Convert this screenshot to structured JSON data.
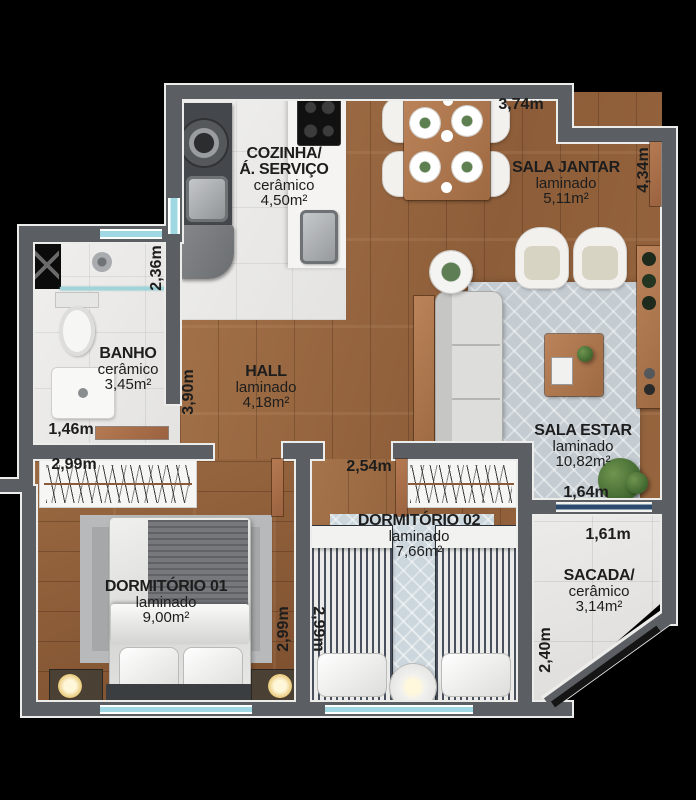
{
  "rooms": {
    "cozinha": {
      "name": "COZINHA/",
      "name2": "Á. SERVIÇO",
      "material": "cerâmico",
      "area": "4,50m²"
    },
    "sala_jantar": {
      "name": "SALA JANTAR",
      "material": "laminado",
      "area": "5,11m²"
    },
    "banho": {
      "name": "BANHO",
      "material": "cerâmico",
      "area": "3,45m²"
    },
    "hall": {
      "name": "HALL",
      "material": "laminado",
      "area": "4,18m²"
    },
    "sala_estar": {
      "name": "SALA ESTAR",
      "material": "laminado",
      "area": "10,82m²"
    },
    "dormitorio1": {
      "name": "DORMITÓRIO 01",
      "material": "laminado",
      "area": "9,00m²"
    },
    "dormitorio2": {
      "name": "DORMITÓRIO 02",
      "material": "laminado",
      "area": "7,66m²"
    },
    "sacada": {
      "name": "SACADA/",
      "material": "cerâmico",
      "area": "3,14m²"
    }
  },
  "dimensions": {
    "jantar_top": "3,74m",
    "entry_right": "4,34m",
    "banho_height": "2,36m",
    "banho_width": "1,46m",
    "hall_height": "3,90m",
    "dorm1_closet_width": "2,99m",
    "dorm1_height": "2,99m",
    "dorm2_height": "2,99m",
    "dorm2_width": "2,54m",
    "estar_bottom_width": "1,64m",
    "sacada_width": "1,61m",
    "sacada_height": "2,40m"
  },
  "colors": {
    "wall": "#5b5f63",
    "wall_outline": "#ececea",
    "wood_floor": "#9b6a43",
    "window_glass": "#9fd8e2",
    "sacada_door_glass": "#2c4a6e",
    "background": "#000000"
  }
}
